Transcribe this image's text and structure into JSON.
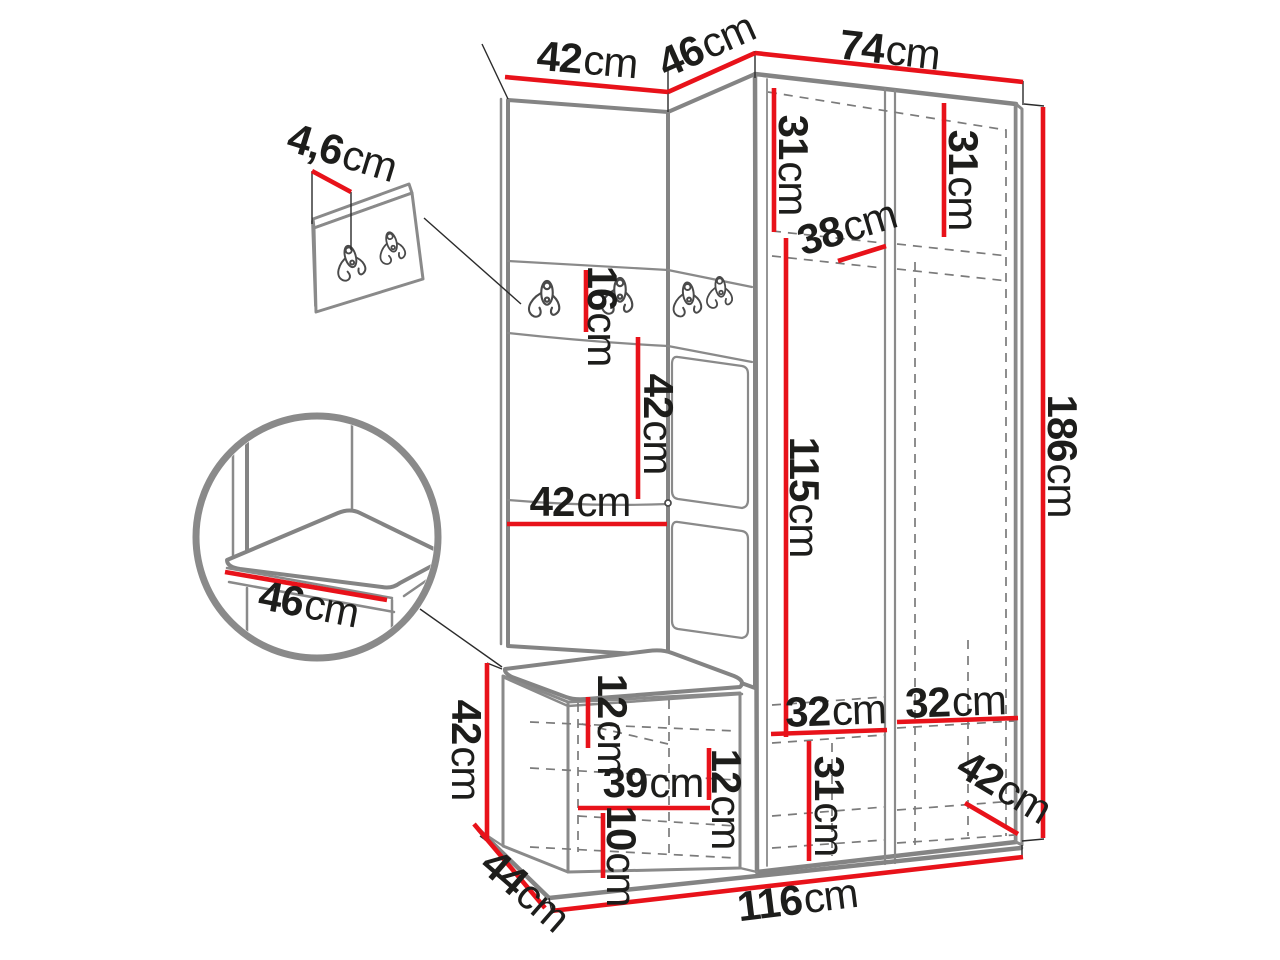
{
  "diagram": {
    "colors": {
      "dimension_line": "#e8121a",
      "furniture_outline": "#848484",
      "label_text": "#1d1d1b"
    },
    "dimensions": {
      "panel_depth": {
        "value": "4,6",
        "unit": "cm"
      },
      "left_cabinet_width": {
        "value": "42",
        "unit": "cm"
      },
      "corner_section_width": {
        "value": "46",
        "unit": "cm"
      },
      "wardrobe_width": {
        "value": "74",
        "unit": "cm"
      },
      "wardrobe_left_shelf_height": {
        "value": "31",
        "unit": "cm"
      },
      "wardrobe_right_shelf_height": {
        "value": "31",
        "unit": "cm"
      },
      "wardrobe_shelf_depth": {
        "value": "38",
        "unit": "cm"
      },
      "hook_panel_height": {
        "value": "16",
        "unit": "cm"
      },
      "mid_panel_height": {
        "value": "42",
        "unit": "cm"
      },
      "mid_panel_width": {
        "value": "42",
        "unit": "cm"
      },
      "wardrobe_interior_height": {
        "value": "115",
        "unit": "cm"
      },
      "total_height": {
        "value": "186",
        "unit": "cm"
      },
      "bench_height": {
        "value": "42",
        "unit": "cm"
      },
      "seat_thickness_offset": {
        "value": "12",
        "unit": "cm"
      },
      "shoe_shelf_width": {
        "value": "39",
        "unit": "cm"
      },
      "shoe_shelf_spacing": {
        "value": "12",
        "unit": "cm"
      },
      "bottom_shelf_height": {
        "value": "10",
        "unit": "cm"
      },
      "wardrobe_bottom_left_width": {
        "value": "32",
        "unit": "cm"
      },
      "wardrobe_bottom_right_width": {
        "value": "32",
        "unit": "cm"
      },
      "wardrobe_bottom_compartment_height": {
        "value": "31",
        "unit": "cm"
      },
      "wardrobe_bottom_depth": {
        "value": "42",
        "unit": "cm"
      },
      "base_depth": {
        "value": "44",
        "unit": "cm"
      },
      "base_width": {
        "value": "116",
        "unit": "cm"
      },
      "seat_depth": {
        "value": "46",
        "unit": "cm"
      }
    }
  }
}
